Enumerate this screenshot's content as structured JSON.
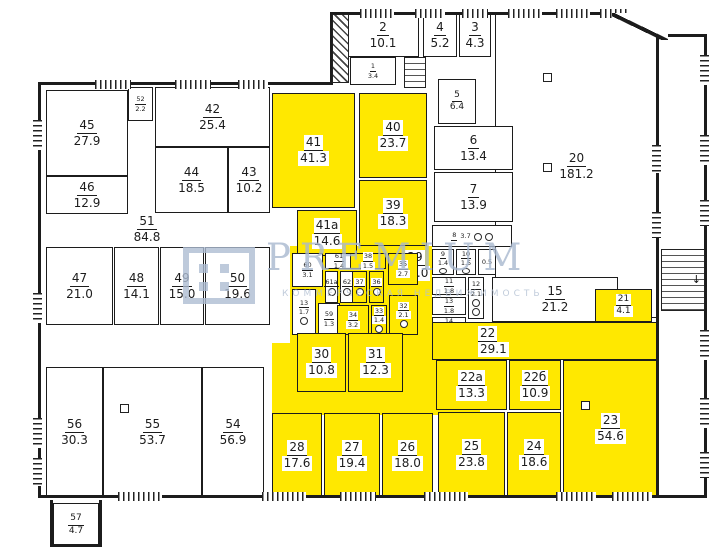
{
  "plan": {
    "width": 725,
    "height": 559,
    "colors": {
      "highlight": "#ffe800",
      "wall": "#1c1c1c",
      "watermark": "#a8b8cf"
    },
    "watermark": {
      "line1": "PREMIUM",
      "line2": "КОММЕРЧЕСКАЯ НЕДВИЖИМОСТЬ"
    },
    "patches": [
      {
        "x": 290,
        "y": 246,
        "w": 142,
        "h": 99
      },
      {
        "x": 272,
        "y": 343,
        "w": 208,
        "h": 72
      }
    ],
    "rooms": [
      {
        "n": "20",
        "a": "181.2",
        "x": 495,
        "y": 14,
        "w": 163,
        "h": 304
      },
      {
        "n": "2",
        "a": "10.1",
        "x": 347,
        "y": 14,
        "w": 72,
        "h": 43
      },
      {
        "n": "4",
        "a": "5.2",
        "x": 423,
        "y": 14,
        "w": 34,
        "h": 43
      },
      {
        "n": "3",
        "a": "4.3",
        "x": 459,
        "y": 14,
        "w": 32,
        "h": 43
      },
      {
        "n": "1",
        "a": "3.4",
        "x": 350,
        "y": 57,
        "w": 46,
        "h": 28,
        "sz": "sm"
      },
      {
        "n": "5",
        "a": "6.4",
        "x": 438,
        "y": 79,
        "w": 38,
        "h": 45,
        "sz": "md"
      },
      {
        "n": "6",
        "a": "13.4",
        "x": 434,
        "y": 126,
        "w": 79,
        "h": 44
      },
      {
        "n": "7",
        "a": "13.9",
        "x": 434,
        "y": 172,
        "w": 79,
        "h": 50
      },
      {
        "n": "45",
        "a": "27.9",
        "x": 46,
        "y": 90,
        "w": 82,
        "h": 86
      },
      {
        "n": "46",
        "a": "12.9",
        "x": 46,
        "y": 176,
        "w": 82,
        "h": 38
      },
      {
        "n": "52",
        "a": "2.2",
        "x": 128,
        "y": 87,
        "w": 25,
        "h": 34,
        "sz": "sm"
      },
      {
        "n": "42",
        "a": "25.4",
        "x": 155,
        "y": 87,
        "w": 115,
        "h": 60
      },
      {
        "n": "44",
        "a": "18.5",
        "x": 155,
        "y": 147,
        "w": 73,
        "h": 66
      },
      {
        "n": "43",
        "a": "10.2",
        "x": 228,
        "y": 147,
        "w": 42,
        "h": 66
      },
      {
        "n": "51",
        "a": "84.8",
        "x": 112,
        "y": 212,
        "w": 70,
        "h": 34,
        "nob": 1
      },
      {
        "n": "47",
        "a": "21.0",
        "x": 46,
        "y": 247,
        "w": 67,
        "h": 78
      },
      {
        "n": "48",
        "a": "14.1",
        "x": 114,
        "y": 247,
        "w": 45,
        "h": 78
      },
      {
        "n": "49",
        "a": "15.0",
        "x": 160,
        "y": 247,
        "w": 44,
        "h": 78
      },
      {
        "n": "50",
        "a": "19.6",
        "x": 205,
        "y": 247,
        "w": 65,
        "h": 78
      },
      {
        "n": "56",
        "a": "30.3",
        "x": 46,
        "y": 367,
        "w": 57,
        "h": 130
      },
      {
        "n": "55",
        "a": "53.7",
        "x": 103,
        "y": 367,
        "w": 99,
        "h": 130
      },
      {
        "n": "54",
        "a": "56.9",
        "x": 202,
        "y": 367,
        "w": 62,
        "h": 130
      },
      {
        "n": "57",
        "a": "4.7",
        "x": 53,
        "y": 503,
        "w": 46,
        "h": 44,
        "sz": "md"
      },
      {
        "n": "41",
        "a": "41.3",
        "x": 272,
        "y": 93,
        "w": 83,
        "h": 115,
        "hl": 1
      },
      {
        "n": "40",
        "a": "23.7",
        "x": 359,
        "y": 93,
        "w": 68,
        "h": 85,
        "hl": 1
      },
      {
        "n": "39",
        "a": "18.3",
        "x": 359,
        "y": 180,
        "w": 68,
        "h": 66,
        "hl": 1
      },
      {
        "n": "41а",
        "a": "14.6",
        "x": 297,
        "y": 210,
        "w": 60,
        "h": 46,
        "hl": 1
      },
      {
        "n": "29",
        "a": "37.0",
        "x": 388,
        "y": 247,
        "w": 54,
        "h": 36,
        "nob": 1,
        "chip": 1
      },
      {
        "n": "60",
        "a": "3.1",
        "x": 292,
        "y": 253,
        "w": 31,
        "h": 34,
        "sz": "sm"
      },
      {
        "n": "61",
        "a": "1.4",
        "x": 325,
        "y": 253,
        "w": 28,
        "h": 16,
        "sz": "sm"
      },
      {
        "n": "61а",
        "a": "",
        "x": 325,
        "y": 271,
        "w": 13,
        "h": 32,
        "sz": "sm",
        "wc": 1
      },
      {
        "n": "62",
        "a": "",
        "x": 340,
        "y": 271,
        "w": 14,
        "h": 32,
        "sz": "sm",
        "wc": 1
      },
      {
        "n": "13",
        "a": "1.7",
        "x": 292,
        "y": 289,
        "w": 24,
        "h": 46,
        "sz": "sm",
        "wc": 1
      },
      {
        "n": "59",
        "a": "1.3",
        "x": 318,
        "y": 303,
        "w": 22,
        "h": 32,
        "sz": "sm"
      },
      {
        "n": "38",
        "a": "1.5",
        "x": 350,
        "y": 253,
        "w": 36,
        "h": 16,
        "hl": 1,
        "sz": "sm"
      },
      {
        "n": "37",
        "a": "",
        "x": 352,
        "y": 271,
        "w": 15,
        "h": 32,
        "hl": 1,
        "sz": "sm",
        "wc": 1
      },
      {
        "n": "36",
        "a": "",
        "x": 369,
        "y": 271,
        "w": 15,
        "h": 32,
        "hl": 1,
        "sz": "sm",
        "wc": 1
      },
      {
        "n": "35",
        "a": "2.7",
        "x": 388,
        "y": 253,
        "w": 30,
        "h": 32,
        "hl": 1,
        "sz": "sm"
      },
      {
        "n": "34",
        "a": "3.2",
        "x": 337,
        "y": 305,
        "w": 32,
        "h": 30,
        "hl": 1,
        "sz": "sm"
      },
      {
        "n": "33",
        "a": "1.4",
        "x": 371,
        "y": 305,
        "w": 16,
        "h": 30,
        "hl": 1,
        "sz": "sm",
        "wc": 1
      },
      {
        "n": "32",
        "a": "2.1",
        "x": 389,
        "y": 295,
        "w": 29,
        "h": 40,
        "hl": 1,
        "sz": "sm",
        "wc": 1
      },
      {
        "n": "8",
        "a": "3.7",
        "x": 432,
        "y": 225,
        "w": 80,
        "h": 22,
        "sz": "sm",
        "row": 1,
        "wc": 2
      },
      {
        "n": "9",
        "a": "1.4",
        "x": 432,
        "y": 249,
        "w": 22,
        "h": 26,
        "sz": "sm",
        "wc": 1
      },
      {
        "n": "10",
        "a": "1.5",
        "x": 456,
        "y": 249,
        "w": 20,
        "h": 26,
        "sz": "sm",
        "wc": 1
      },
      {
        "n": "",
        "a": "0.5",
        "x": 478,
        "y": 249,
        "w": 18,
        "h": 26,
        "sz": "sm"
      },
      {
        "n": "11",
        "a": "1.8",
        "x": 432,
        "y": 277,
        "w": 34,
        "h": 18,
        "sz": "sm"
      },
      {
        "n": "12",
        "a": "2.1",
        "x": 468,
        "y": 277,
        "w": 16,
        "h": 42,
        "sz": "sm",
        "wc": 2
      },
      {
        "n": "13",
        "a": "1.8",
        "x": 432,
        "y": 297,
        "w": 34,
        "h": 18,
        "sz": "sm"
      },
      {
        "n": "14",
        "a": "1.8",
        "x": 432,
        "y": 317,
        "w": 34,
        "h": 18,
        "sz": "sm"
      },
      {
        "n": "15",
        "a": "21.2",
        "x": 492,
        "y": 277,
        "w": 126,
        "h": 45
      },
      {
        "n": "21",
        "a": "4.1",
        "x": 595,
        "y": 289,
        "w": 57,
        "h": 33,
        "hl": 1,
        "sz": "md"
      },
      {
        "n": "30",
        "a": "10.8",
        "x": 297,
        "y": 333,
        "w": 49,
        "h": 59,
        "hl": 1
      },
      {
        "n": "31",
        "a": "12.3",
        "x": 348,
        "y": 333,
        "w": 55,
        "h": 59,
        "hl": 1
      },
      {
        "n": "28",
        "a": "17.6",
        "x": 272,
        "y": 413,
        "w": 50,
        "h": 84,
        "hl": 1
      },
      {
        "n": "27",
        "a": "19.4",
        "x": 324,
        "y": 413,
        "w": 56,
        "h": 84,
        "hl": 1
      },
      {
        "n": "26",
        "a": "18.0",
        "x": 382,
        "y": 413,
        "w": 51,
        "h": 84,
        "hl": 1
      },
      {
        "n": "22",
        "a": "29.1",
        "x": 432,
        "y": 322,
        "w": 226,
        "h": 38,
        "hl": 1,
        "lleft": 1
      },
      {
        "n": "22а",
        "a": "13.3",
        "x": 436,
        "y": 360,
        "w": 71,
        "h": 50,
        "hl": 1
      },
      {
        "n": "22б",
        "a": "10.9",
        "x": 509,
        "y": 360,
        "w": 52,
        "h": 50,
        "hl": 1
      },
      {
        "n": "23",
        "a": "54.6",
        "x": 563,
        "y": 360,
        "w": 95,
        "h": 137,
        "hl": 1
      },
      {
        "n": "25",
        "a": "23.8",
        "x": 438,
        "y": 412,
        "w": 67,
        "h": 85,
        "hl": 1
      },
      {
        "n": "24",
        "a": "18.6",
        "x": 507,
        "y": 412,
        "w": 54,
        "h": 85,
        "hl": 1
      }
    ],
    "walls": [
      {
        "x": 330,
        "y": 12,
        "w": 288,
        "h": 3
      },
      {
        "x": 664,
        "y": 34,
        "w": 43,
        "h": 3
      },
      {
        "x": 704,
        "y": 34,
        "w": 3,
        "h": 464
      },
      {
        "x": 38,
        "y": 82,
        "w": 295,
        "h": 3
      },
      {
        "x": 38,
        "y": 82,
        "w": 3,
        "h": 416
      },
      {
        "x": 38,
        "y": 495,
        "w": 669,
        "h": 3
      },
      {
        "x": 330,
        "y": 12,
        "w": 3,
        "h": 73
      },
      {
        "x": 656,
        "y": 14,
        "w": 3,
        "h": 483
      },
      {
        "x": 50,
        "y": 500,
        "w": 3,
        "h": 47
      },
      {
        "x": 50,
        "y": 544,
        "w": 52,
        "h": 3
      },
      {
        "x": 99,
        "y": 500,
        "w": 3,
        "h": 47
      }
    ],
    "windows": [
      {
        "o": "v",
        "x": 33,
        "y": 120,
        "l": 30
      },
      {
        "o": "v",
        "x": 33,
        "y": 293,
        "l": 30
      },
      {
        "o": "v",
        "x": 33,
        "y": 418,
        "l": 30
      },
      {
        "o": "v",
        "x": 33,
        "y": 458,
        "l": 28
      },
      {
        "o": "v",
        "x": 700,
        "y": 55,
        "l": 30
      },
      {
        "o": "v",
        "x": 700,
        "y": 135,
        "l": 30
      },
      {
        "o": "v",
        "x": 700,
        "y": 200,
        "l": 26
      },
      {
        "o": "v",
        "x": 700,
        "y": 330,
        "l": 30
      },
      {
        "o": "v",
        "x": 700,
        "y": 398,
        "l": 30
      },
      {
        "o": "v",
        "x": 700,
        "y": 452,
        "l": 26
      },
      {
        "o": "v",
        "x": 652,
        "y": 145,
        "l": 28
      },
      {
        "o": "v",
        "x": 652,
        "y": 212,
        "l": 26
      },
      {
        "o": "h",
        "x": 95,
        "y": 80,
        "l": 36
      },
      {
        "o": "h",
        "x": 175,
        "y": 80,
        "l": 36
      },
      {
        "o": "h",
        "x": 238,
        "y": 80,
        "l": 30
      },
      {
        "o": "h",
        "x": 360,
        "y": 9,
        "l": 34
      },
      {
        "o": "h",
        "x": 415,
        "y": 9,
        "l": 30
      },
      {
        "o": "h",
        "x": 462,
        "y": 9,
        "l": 26
      },
      {
        "o": "h",
        "x": 508,
        "y": 9,
        "l": 34
      },
      {
        "o": "h",
        "x": 556,
        "y": 9,
        "l": 34
      },
      {
        "o": "h",
        "x": 600,
        "y": 9,
        "l": 30
      },
      {
        "o": "h",
        "x": 118,
        "y": 492,
        "l": 44
      },
      {
        "o": "h",
        "x": 262,
        "y": 492,
        "l": 44
      },
      {
        "o": "h",
        "x": 340,
        "y": 492,
        "l": 36
      },
      {
        "o": "h",
        "x": 424,
        "y": 492,
        "l": 44
      },
      {
        "o": "h",
        "x": 556,
        "y": 492,
        "l": 40
      },
      {
        "o": "h",
        "x": 612,
        "y": 492,
        "l": 40
      }
    ],
    "stairs": [
      {
        "t": "diag",
        "x": 332,
        "y": 14,
        "w": 17,
        "h": 69
      },
      {
        "t": "tread",
        "x": 404,
        "y": 57,
        "w": 22,
        "h": 31
      },
      {
        "t": "tread",
        "x": 661,
        "y": 249,
        "w": 44,
        "h": 62,
        "arrow": 1
      }
    ],
    "columns": [
      {
        "x": 543,
        "y": 73
      },
      {
        "x": 543,
        "y": 163
      },
      {
        "x": 120,
        "y": 404
      },
      {
        "x": 581,
        "y": 401
      }
    ],
    "corner": {
      "x": 612,
      "y": 13,
      "w": 56,
      "h": 27
    }
  }
}
